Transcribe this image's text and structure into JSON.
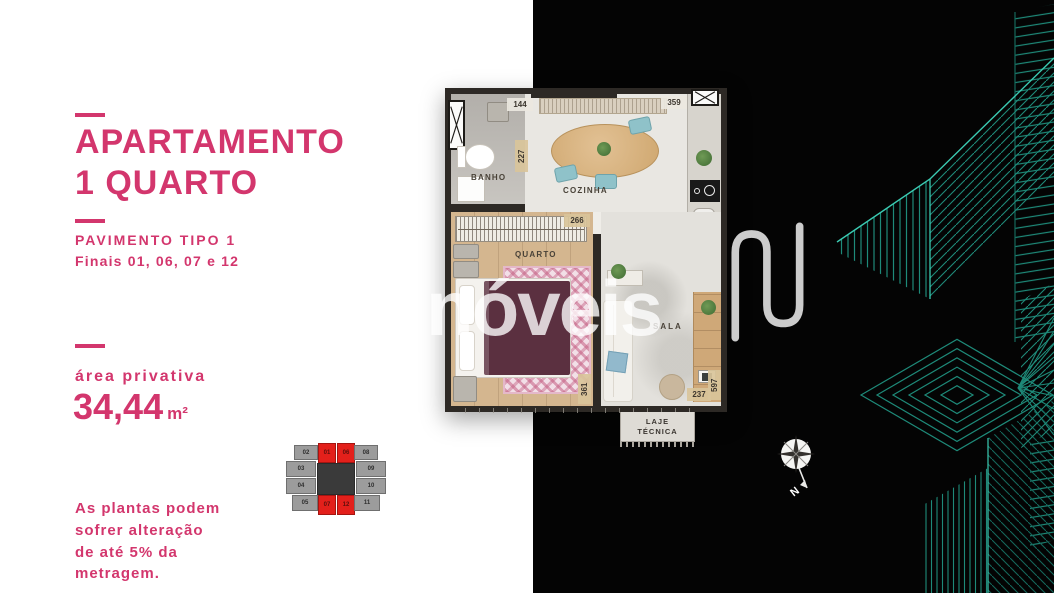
{
  "brand": {
    "watermark_text": "nóveis",
    "accent_pink": "#d3366d",
    "accent_teal": "#1e8a79",
    "highlight_red": "#e3201b"
  },
  "left_panel": {
    "title_line1": "APARTAMENTO",
    "title_line2": "1 QUARTO",
    "subtitle_line1": "PAVIMENTO TIPO 1",
    "subtitle_line2": "Finais 01, 06, 07 e 12",
    "area_label": "área privativa",
    "area_value": "34,44",
    "area_unit": "m²",
    "disclaimer": "As plantas podem\nsofrer alteração\nde até 5% da\nmetragem."
  },
  "keyplan": {
    "left_units": [
      "02",
      "03",
      "04",
      "05"
    ],
    "right_units": [
      "08",
      "09",
      "10",
      "11"
    ],
    "highlighted_top": [
      "01",
      "06"
    ],
    "highlighted_bottom": [
      "07",
      "12"
    ]
  },
  "floorplan": {
    "rooms": {
      "bathroom": "BANHO",
      "kitchen": "COZINHA",
      "bedroom": "QUARTO",
      "living": "SALA",
      "technical": "LAJE TÉCNICA"
    },
    "dimensions": {
      "banho_top": "144",
      "banho_wall": "227",
      "cozinha_top": "359",
      "quarto_wall": "266",
      "quarto_bottom": "361",
      "sala_bottom": "237",
      "sala_side": "597"
    }
  },
  "compass": {
    "label": "N"
  }
}
